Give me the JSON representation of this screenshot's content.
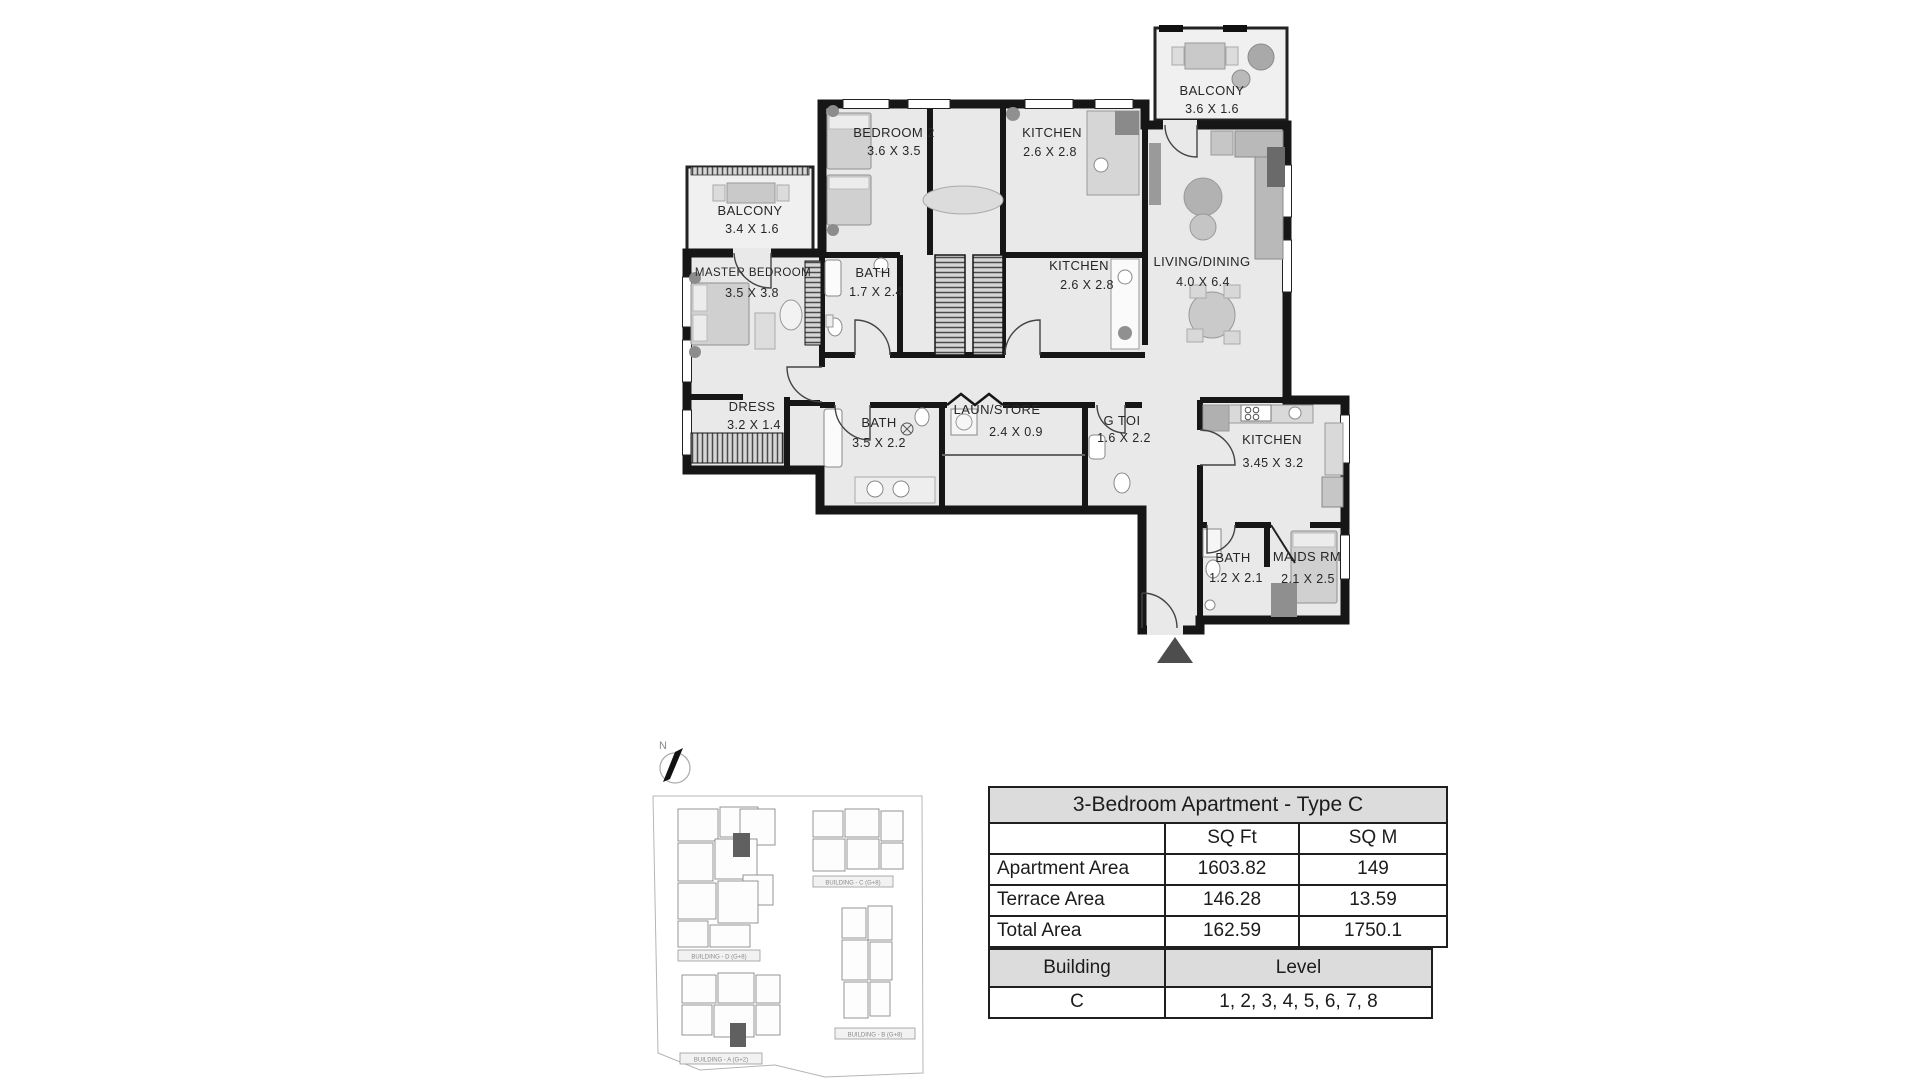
{
  "floor_plan": {
    "rooms": [
      {
        "name": "BEDROOM 2",
        "dims": "3.6 X 3.5"
      },
      {
        "name": "KITCHEN",
        "dims": "2.6 X 2.8"
      },
      {
        "name": "BALCONY",
        "dims": "3.6 X 1.6"
      },
      {
        "name": "BALCONY",
        "dims": "3.4 X 1.6"
      },
      {
        "name": "MASTER BEDROOM",
        "dims": "3.5 X 3.8"
      },
      {
        "name": "BATH",
        "dims": "1.7 X 2.4"
      },
      {
        "name": "KITCHEN",
        "dims": "2.6 X 2.8"
      },
      {
        "name": "LIVING/DINING",
        "dims": "4.0 X 6.4"
      },
      {
        "name": "DRESS",
        "dims": "3.2 X 1.4"
      },
      {
        "name": "BATH",
        "dims": "3.5 X 2.2"
      },
      {
        "name": "LAUN/STORE",
        "dims": "2.4 X 0.9"
      },
      {
        "name": "G TOI",
        "dims": "1.6 X 2.2"
      },
      {
        "name": "KITCHEN",
        "dims": "3.45 X 3.2"
      },
      {
        "name": "BATH",
        "dims": "1.2 X 2.1"
      },
      {
        "name": "MAIDS RM",
        "dims": "2.1 X 2.5"
      }
    ]
  },
  "site_plan": {
    "north_label": "N",
    "buildings": [
      {
        "label": "BUILDING - D (G+8)"
      },
      {
        "label": "BUILDING - C (G+8)"
      },
      {
        "label": "BUILDING - B (G+8)"
      },
      {
        "label": "BUILDING - A (G+2)"
      }
    ]
  },
  "area_table": {
    "title": "3-Bedroom Apartment - Type C",
    "col_headers": [
      "",
      "SQ Ft",
      "SQ M"
    ],
    "rows": [
      {
        "label": "Apartment Area",
        "sqft": "1603.82",
        "sqm": "149"
      },
      {
        "label": "Terrace Area",
        "sqft": "146.28",
        "sqm": "13.59"
      },
      {
        "label": "Total Area",
        "sqft": "162.59",
        "sqm": "1750.1"
      }
    ]
  },
  "building_table": {
    "headers": [
      "Building",
      "Level"
    ],
    "rows": [
      {
        "building": "C",
        "level": "1, 2, 3, 4, 5, 6, 7, 8"
      }
    ]
  },
  "colors": {
    "wall": "#1a1a1a",
    "room_fill": "#e9e9e9",
    "highlight_unit": "#606060",
    "table_header_bg": "#dcdcdc"
  }
}
